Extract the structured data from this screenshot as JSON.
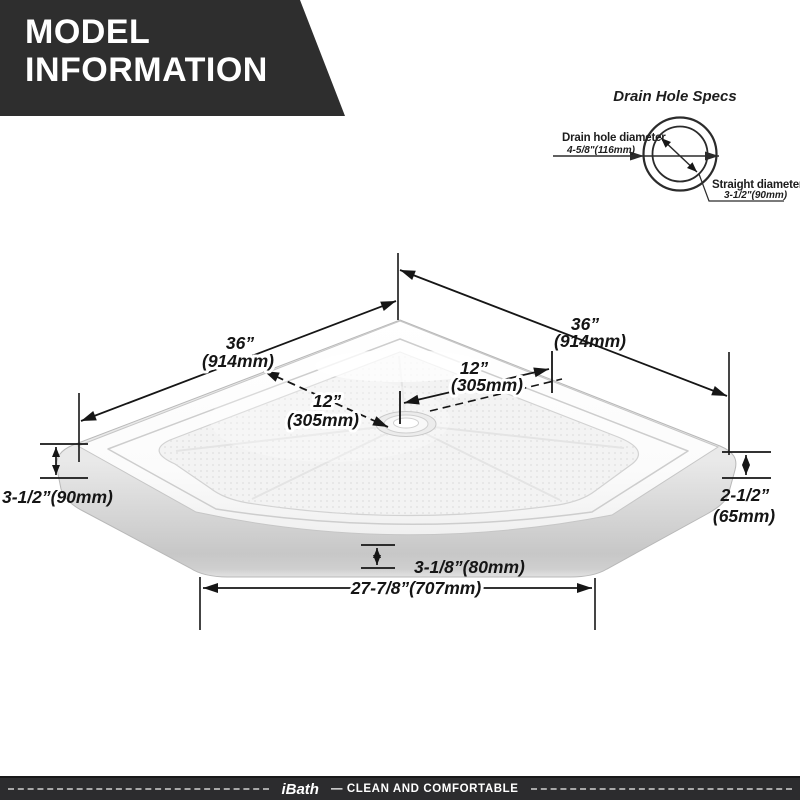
{
  "banner": {
    "line1": "MODEL",
    "line2": "INFORMATION"
  },
  "drain_specs": {
    "title": "Drain Hole Specs",
    "hole_label": "Drain hole diameter",
    "hole_value": "4-5/8\"(116mm)",
    "straight_label": "Straight diameter",
    "straight_value": "3-1/2\"(90mm)"
  },
  "dimensions": {
    "back_left_in": "36”",
    "back_left_mm": "(914mm)",
    "back_right_in": "36”",
    "back_right_mm": "(914mm)",
    "drain_left_in": "12”",
    "drain_left_mm": "(305mm)",
    "drain_right_in": "12”",
    "drain_right_mm": "(305mm)",
    "left_height": "3-1/2”(90mm)",
    "right_height_in": "2-1/2”",
    "right_height_mm": "(65mm)",
    "apron_height": "3-1/8”(80mm)",
    "front_width": "27-7/8”(707mm)"
  },
  "footer": {
    "brand": "iBath",
    "tagline": "— CLEAN AND COMFORTABLE"
  },
  "colors": {
    "banner_bg": "#2e2e2e",
    "footer_bg": "#2c2c2e",
    "dim_line": "#161616",
    "drain_line": "#2b2b2b",
    "pan_wall": "#cfcfcf",
    "pan_floor": "#f3f3f3",
    "footer_dash": "#a8a8a8"
  }
}
